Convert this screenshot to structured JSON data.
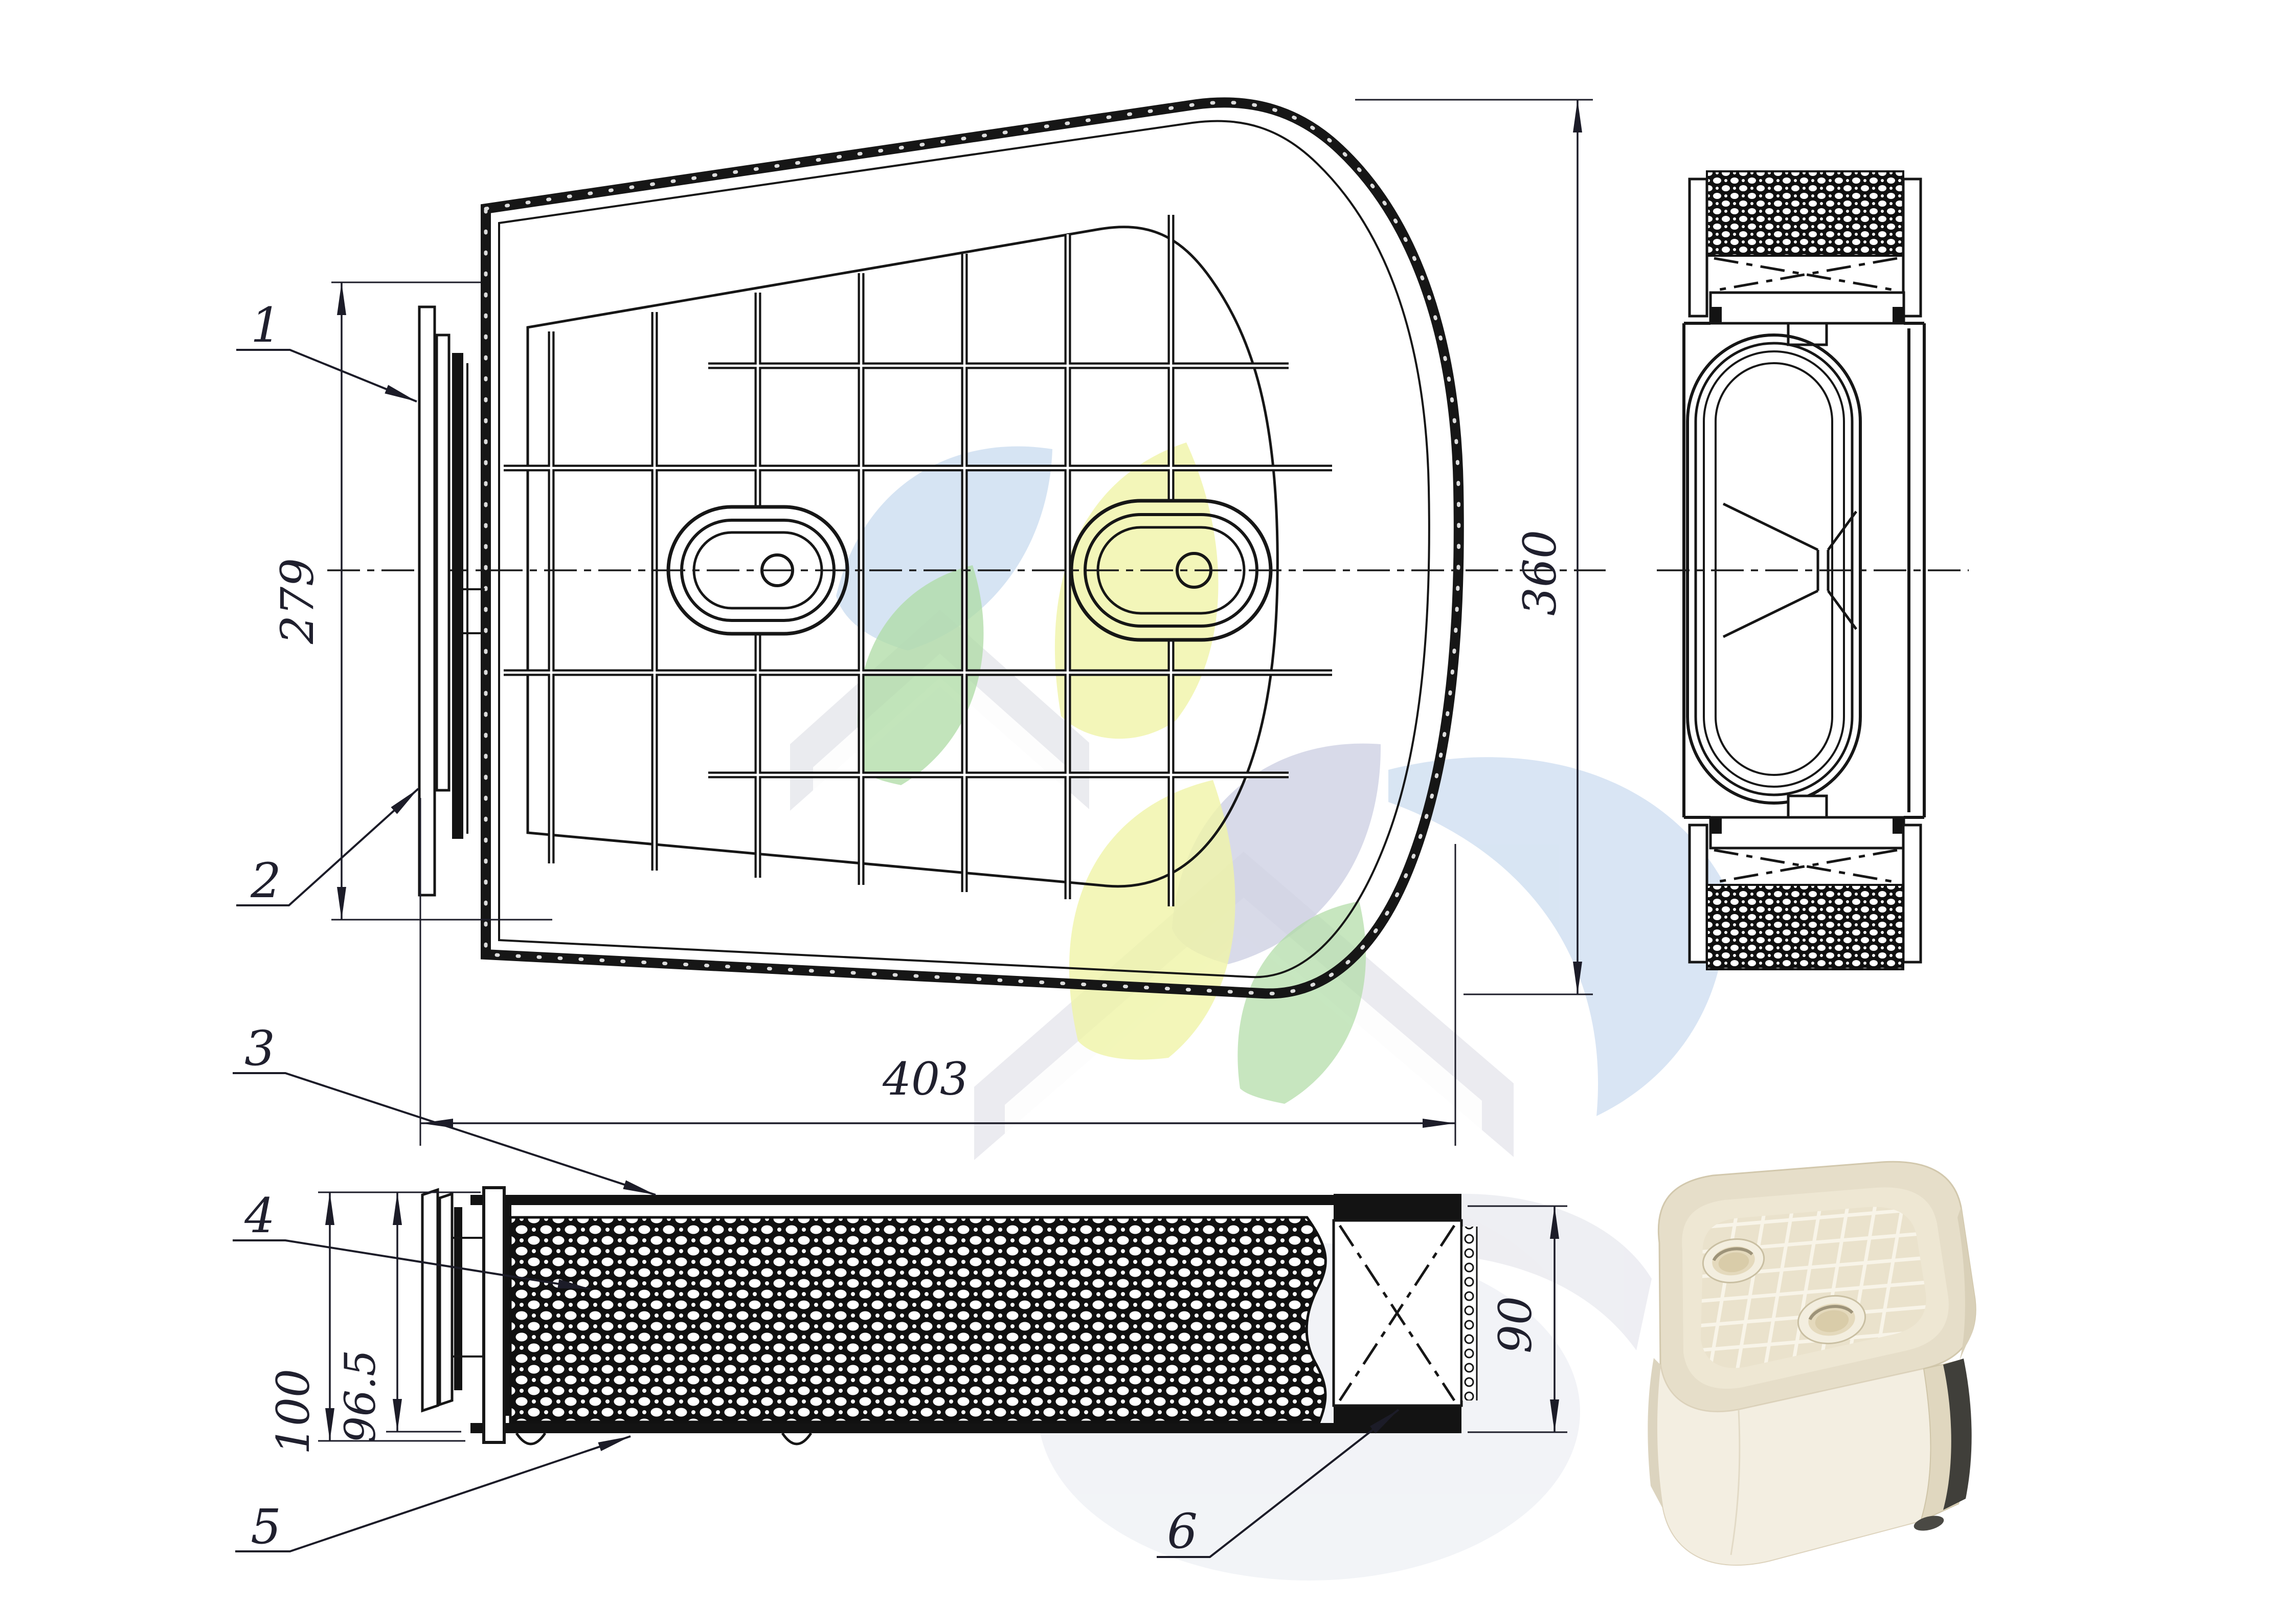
{
  "page": {
    "background": "#ffffff",
    "ink_color": "#161616"
  },
  "callouts": [
    {
      "label": "1"
    },
    {
      "label": "2"
    },
    {
      "label": "3"
    },
    {
      "label": "4"
    },
    {
      "label": "5"
    },
    {
      "label": "6"
    }
  ],
  "dimensions": {
    "flange_height": "279",
    "body_height": "360",
    "body_width": "403",
    "element_height_total": "100",
    "element_height_inner": "96.5",
    "outlet_height": "90"
  },
  "views": {
    "main": "top view of filter housing with rib grid and two oval bosses",
    "side": "end view with filter media sections",
    "bottom": "side view with perforated screen and outlet end cap",
    "photo": "product photo of air filter element"
  },
  "watermark_colors": {
    "yellow": "#eef29e",
    "green": "#a6d89b",
    "blue": "#cdddf0",
    "lavender": "#c9cce0",
    "gray": "#e3e4ea"
  },
  "photo_colors": {
    "body_cream": "#e8e0ca",
    "face_light": "#f3eee1",
    "seal_dark": "#403f3a"
  }
}
